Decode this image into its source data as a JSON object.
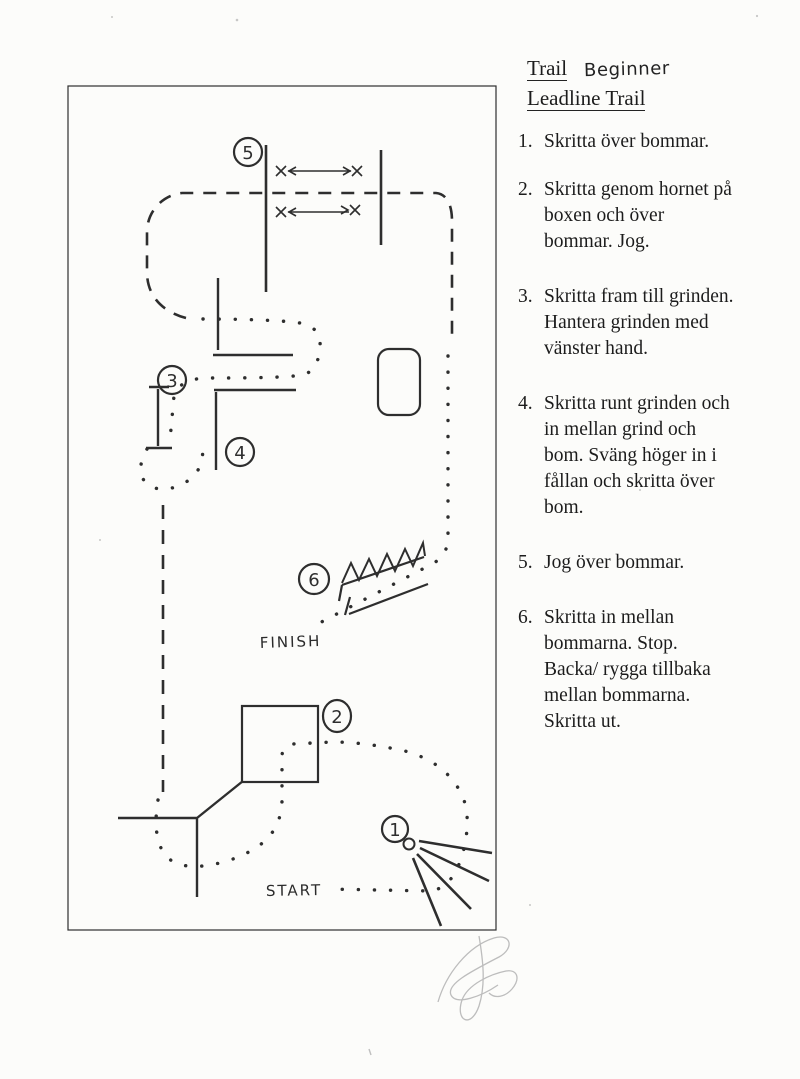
{
  "header": {
    "title": "Trail",
    "level": "Beginner",
    "subtitle": "Leadline Trail"
  },
  "instructions": [
    {
      "number": "1.",
      "text": "Skritta över bommar."
    },
    {
      "number": "2.",
      "text": "Skritta genom hornet på\nboxen och över\nbommar. Jog."
    },
    {
      "number": "3.",
      "text": "Skritta fram till grinden.\nHantera grinden med\nvänster hand."
    },
    {
      "number": "4.",
      "text": "Skritta runt grinden och\nin mellan grind och\nbom. Sväng höger in i\nfållan och skritta över\nbom."
    },
    {
      "number": "5.",
      "text": "Jog över bommar."
    },
    {
      "number": "6.",
      "text": "Skritta in mellan\nbommarna. Stop.\nBacka/ rygga tillbaka\nmellan bommarna.\nSkritta ut."
    }
  ],
  "diagram": {
    "labels": {
      "start": "START",
      "finish": "FINISH"
    },
    "markers": {
      "m1": "1",
      "m2": "2",
      "m3": "3",
      "m4": "4",
      "m5": "5",
      "m6": "6"
    },
    "ink_color": "#2e2e2e",
    "pencil_color": "#9c9c9c"
  }
}
